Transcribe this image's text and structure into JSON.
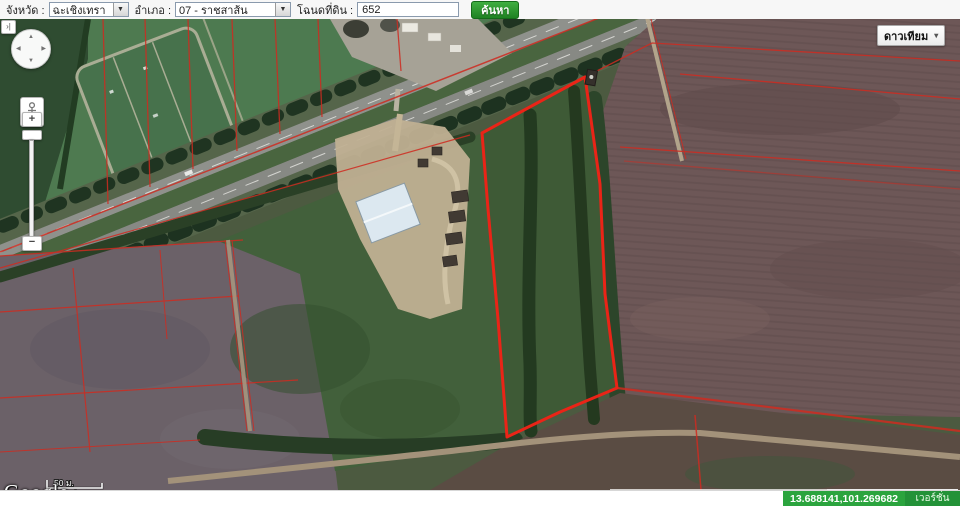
{
  "toolbar": {
    "province_label": "จังหวัด :",
    "province_value": "ฉะเชิงเทรา",
    "district_label": "อำเภอ :",
    "district_value": "07 - ราชสาส้น",
    "deed_label": "โฉนดที่ดิน :",
    "deed_value": "652",
    "search_label": "ค้นหา"
  },
  "map": {
    "type_button": "ดาวเทียม",
    "logo": "Google",
    "scale_metric": "50 ม.",
    "scale_imperial": "200 ฟุต",
    "attribution_imagery": "ภาพ ©2013 DigitalGlobe -",
    "attribution_terms": "ข้อกำหนดในการใช้งาน",
    "attribution_report": "รายงานข้อผิดพลาดของแผนที่",
    "zoom_in": "+",
    "zoom_out": "−",
    "sidebar_toggle": "›|"
  },
  "statusbar": {
    "coordinates": "13.688141,101.269682",
    "version": "เวอร์ชั่น ๓.๐๑"
  },
  "icons": {
    "caret_down": "▾",
    "select_arrow": "▼",
    "pan_up": "▲",
    "pan_down": "▼",
    "pan_left": "◀",
    "pan_right": "▶"
  },
  "colors": {
    "search_button": "#2e9e33",
    "status_bar": "#2ba43e",
    "parcel_outline": "#ea2417",
    "cadastral_line": "#cf2b20"
  }
}
